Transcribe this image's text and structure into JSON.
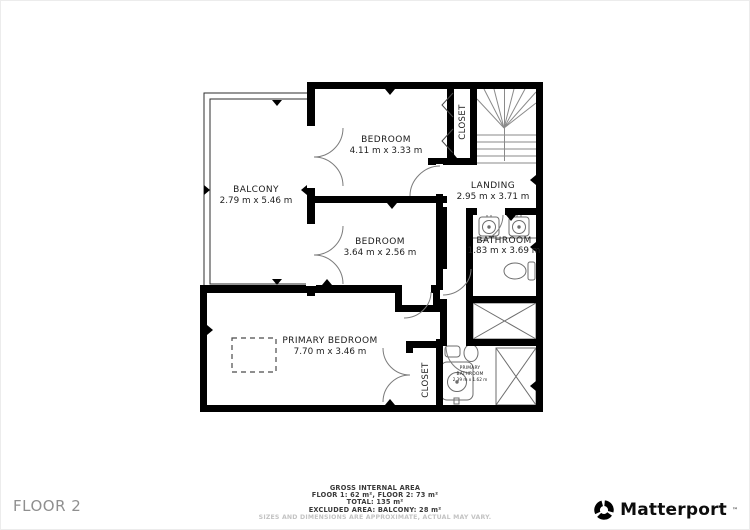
{
  "floor_label": "FLOOR 2",
  "brand": {
    "name": "Matterport",
    "trademark": "™"
  },
  "rooms": {
    "balcony": {
      "name": "BALCONY",
      "dims": "2.79 m x 5.46 m"
    },
    "bedroom_top": {
      "name": "BEDROOM",
      "dims": "4.11 m x 3.33 m"
    },
    "closet_top": {
      "name": "CLOSET"
    },
    "landing": {
      "name": "LANDING",
      "dims": "2.95 m x 3.71 m"
    },
    "bathroom": {
      "name": "BATHROOM",
      "dims": "1.83 m x 3.69 m"
    },
    "bedroom_mid": {
      "name": "BEDROOM",
      "dims": "3.64 m x 2.56 m"
    },
    "primary_bedroom": {
      "name": "PRIMARY BEDROOM",
      "dims": "7.70 m x 3.46 m"
    },
    "closet_bottom": {
      "name": "CLOSET"
    },
    "primary_bathroom": {
      "name_line1": "PRIMARY",
      "name_line2": "BATHROOM",
      "dims": "2.39 m x 1.62 m"
    }
  },
  "footer": {
    "line1": "GROSS INTERNAL AREA",
    "line2": "FLOOR 1: 62 m², FLOOR 2: 73 m²",
    "line3": "TOTAL: 135 m²",
    "line4": "EXCLUDED AREA: BALCONY: 28 m²",
    "disclaimer": "SIZES AND DIMENSIONS ARE APPROXIMATE, ACTUAL MAY VARY."
  },
  "colors": {
    "wall": "#000000",
    "label_text": "#1b1b1b",
    "muted_text": "#8f8f8f",
    "disclaimer_text": "#c3c3c3",
    "background": "#ffffff"
  }
}
